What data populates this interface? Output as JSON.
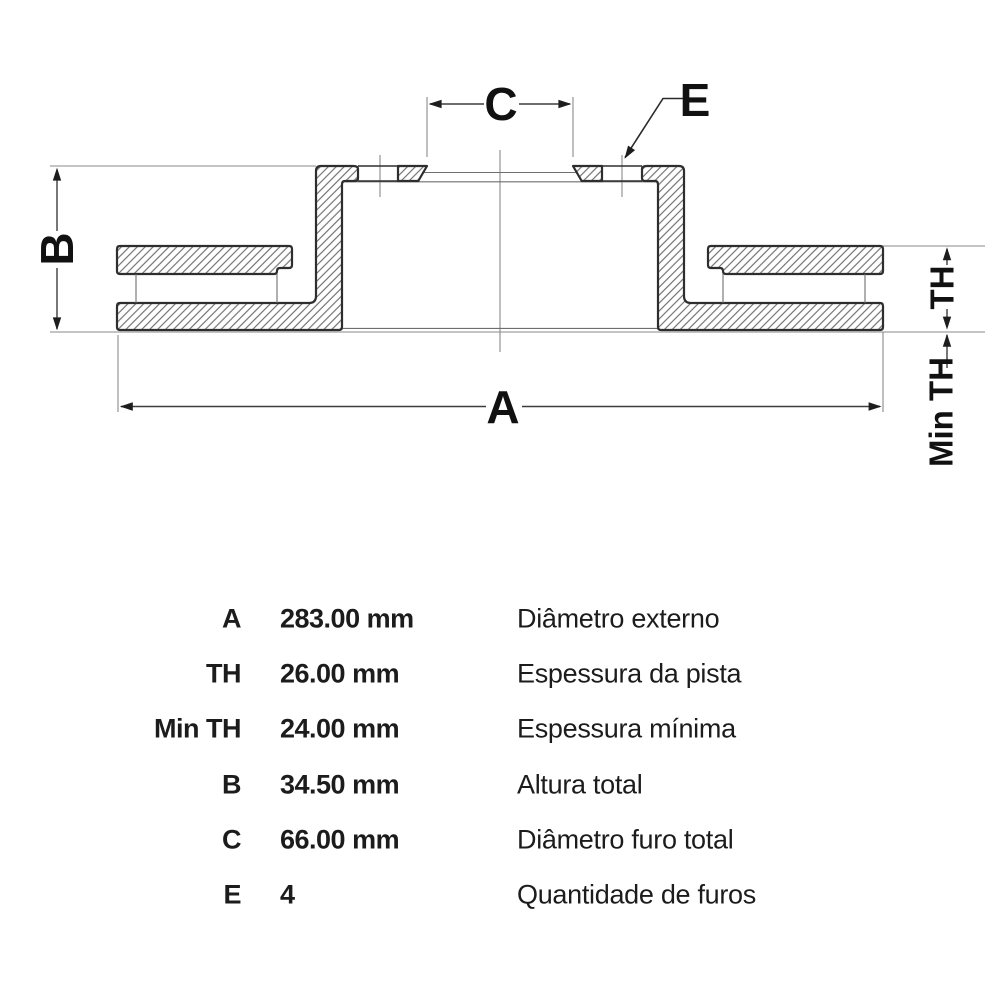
{
  "diagram": {
    "labels": {
      "a": "A",
      "b": "B",
      "c": "C",
      "e": "E",
      "th": "TH",
      "min_th": "Min TH"
    }
  },
  "table": {
    "rows": [
      {
        "label": "A",
        "value": "283.00 mm",
        "desc": "Diâmetro externo"
      },
      {
        "label": "TH",
        "value": "26.00 mm",
        "desc": "Espessura da pista"
      },
      {
        "label": "Min TH",
        "value": "24.00 mm",
        "desc": "Espessura mínima"
      },
      {
        "label": "B",
        "value": "34.50 mm",
        "desc": "Altura total"
      },
      {
        "label": "C",
        "value": "66.00 mm",
        "desc": "Diâmetro furo total"
      },
      {
        "label": "E",
        "value": "4",
        "desc": "Quantidade de furos"
      }
    ]
  },
  "colors": {
    "outline": "#2e2e2e",
    "hatch": "#6e6e6e",
    "thin_line": "#8a8a8a",
    "dimension": "#3d3d3d",
    "text": "#111111",
    "background": "#ffffff"
  }
}
